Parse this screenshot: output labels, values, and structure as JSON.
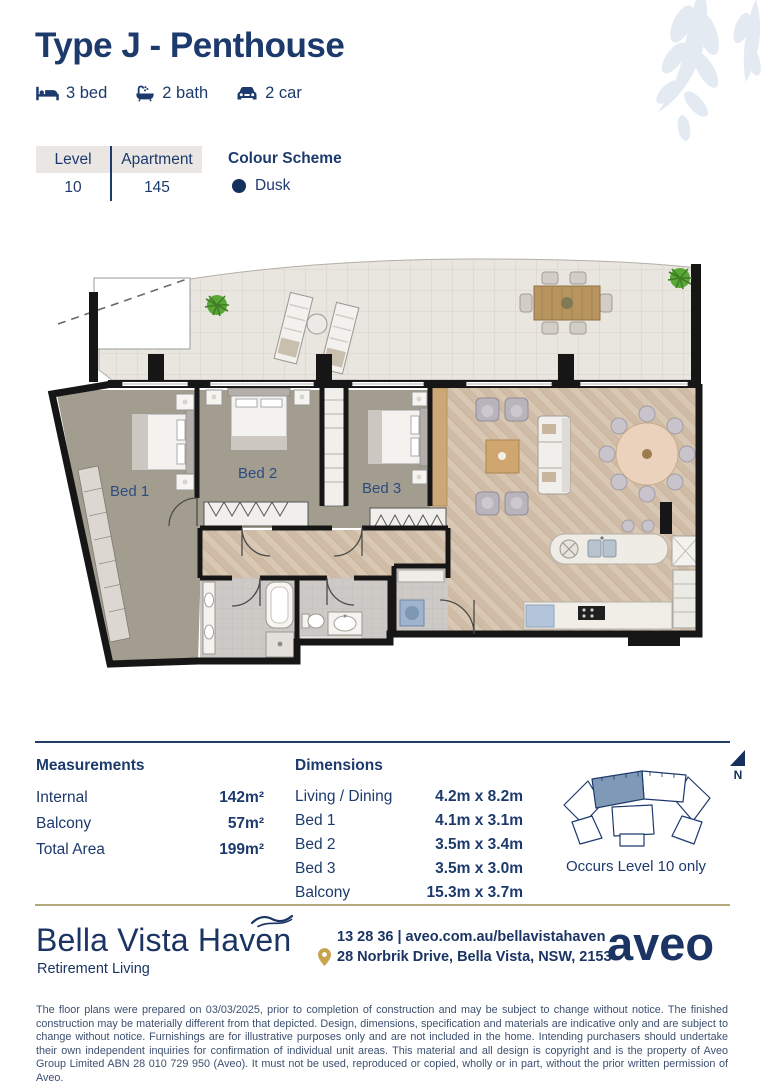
{
  "header": {
    "title": "Type J - Penthouse",
    "features": [
      {
        "icon": "bed-icon",
        "label": "3 bed"
      },
      {
        "icon": "bath-icon",
        "label": "2 bath"
      },
      {
        "icon": "car-icon",
        "label": "2 car"
      }
    ]
  },
  "info": {
    "level_label": "Level",
    "level_value": "10",
    "apartment_label": "Apartment",
    "apartment_value": "145",
    "colour_scheme_label": "Colour Scheme",
    "colour_scheme_value": "Dusk",
    "colour_scheme_hex": "#16305e"
  },
  "floorplan": {
    "labels": {
      "bed1": "Bed 1",
      "bed2": "Bed 2",
      "bed3": "Bed 3"
    }
  },
  "measurements": {
    "heading": "Measurements",
    "rows": [
      {
        "label": "Internal",
        "value": "142m²"
      },
      {
        "label": "Balcony",
        "value": "57m²"
      },
      {
        "label": "Total Area",
        "value": "199m²"
      }
    ]
  },
  "dimensions": {
    "heading": "Dimensions",
    "rows": [
      {
        "label": "Living / Dining",
        "value": "4.2m x 8.2m"
      },
      {
        "label": "Bed 1",
        "value": "4.1m x 3.1m"
      },
      {
        "label": "Bed 2",
        "value": "3.5m x 3.4m"
      },
      {
        "label": "Bed 3",
        "value": "3.5m x 3.0m"
      },
      {
        "label": "Balcony",
        "value": "15.3m x 3.7m"
      }
    ]
  },
  "keyplan": {
    "caption": "Occurs Level 10 only",
    "north": "N",
    "highlight_hex": "#8099b6"
  },
  "footer": {
    "brand": "Bella Vista Haven",
    "tagline": "Retirement Living",
    "phone_web": "13 28 36 | aveo.com.au/bellavistahaven",
    "address": "28 Norbrik Drive, Bella Vista, NSW, 2153",
    "logo": "aveo"
  },
  "disclaimer": "The floor plans were prepared on 03/03/2025, prior to completion of construction and may be subject to change without notice. The finished construction may be materially different from that depicted. Design, dimensions, specification and materials are indicative only and are subject to change without notice. Furnishings are for illustrative purposes only and are not included in the home. Intending purchasers should undertake their own independent inquiries for confirmation of individual unit areas. This material and all design is copyright and is the property of Aveo Group Limited ABN 28 010 729 950 (Aveo). It must not be used, reproduced or copied, wholly or in part, without the prior written permission of Aveo."
}
